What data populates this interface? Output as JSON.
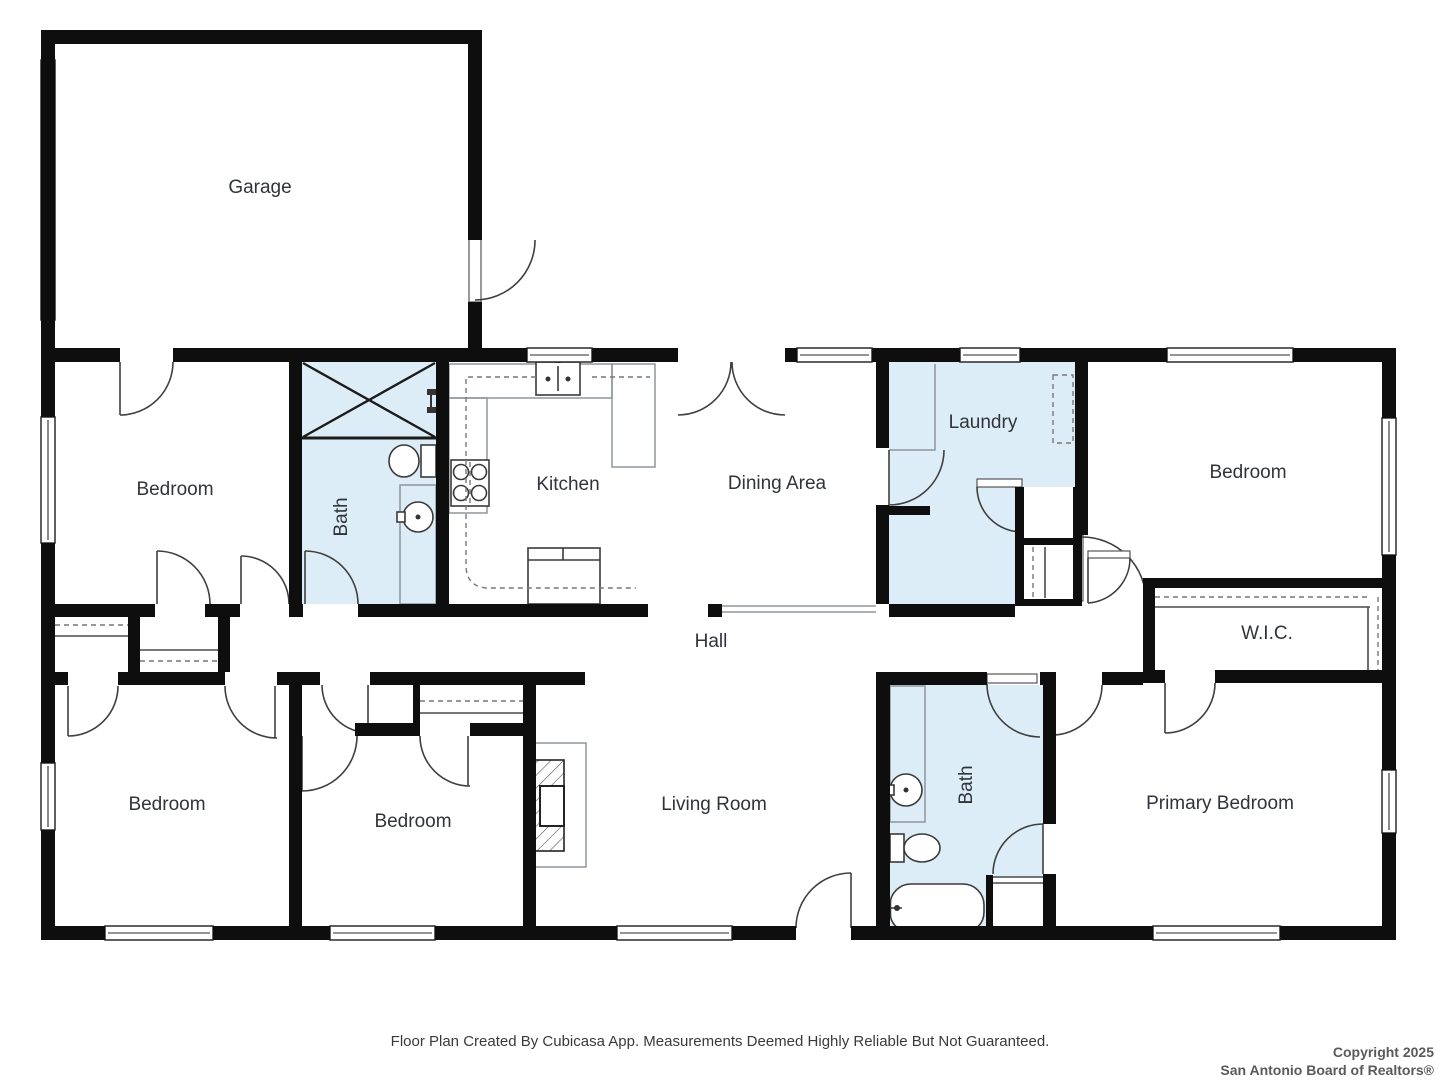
{
  "colors": {
    "wet_area_fill": "#ddedf8",
    "wall": "#0e0e0e",
    "label_text": "#30343a"
  },
  "rooms": {
    "garage": {
      "label": "Garage"
    },
    "bedroom_top_left": {
      "label": "Bedroom"
    },
    "bath_top": {
      "label": "Bath"
    },
    "kitchen": {
      "label": "Kitchen"
    },
    "dining": {
      "label": "Dining Area"
    },
    "laundry": {
      "label": "Laundry"
    },
    "bedroom_top_right": {
      "label": "Bedroom"
    },
    "hall": {
      "label": "Hall"
    },
    "wic": {
      "label": "W.I.C."
    },
    "bedroom_bottom_left": {
      "label": "Bedroom"
    },
    "bedroom_bottom_mid": {
      "label": "Bedroom"
    },
    "living_room": {
      "label": "Living Room"
    },
    "bath_bottom": {
      "label": "Bath"
    },
    "primary_bedroom": {
      "label": "Primary Bedroom"
    }
  },
  "footer": {
    "disclaimer": "Floor Plan Created By Cubicasa App. Measurements Deemed Highly Reliable But Not Guaranteed."
  },
  "copyright": {
    "line1": "Copyright 2025",
    "line2": "San Antonio Board of Realtors®"
  }
}
